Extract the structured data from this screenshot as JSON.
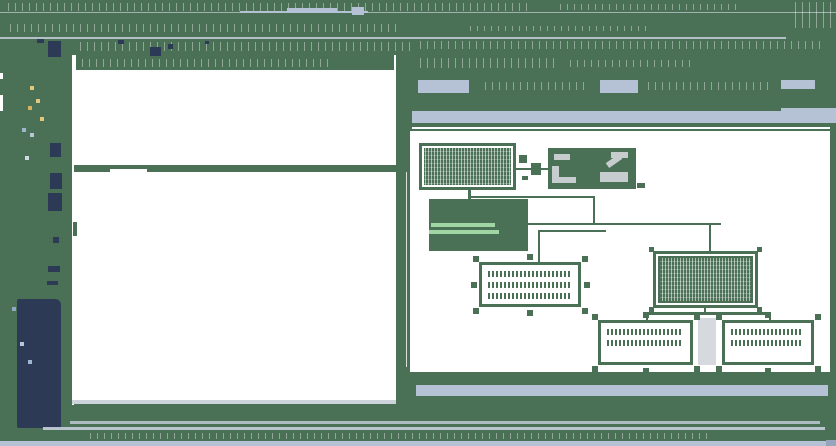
{
  "window": {
    "kind": "workflow-designer",
    "width": 836,
    "height": 446
  },
  "colors": {
    "chrome_green": "#4a7055",
    "navy_panel": "#2d3a55",
    "accent_blue_gray": "#b5c1d5",
    "thin_line_gray": "#c6cfdc",
    "canvas_white": "#ffffff",
    "gray_glyph": "#c7cccf",
    "annotation_text_green": "#9fd6a4"
  },
  "chrome": {
    "title_noise": [
      {
        "x": 8,
        "y": 3,
        "w": 520,
        "h": 8
      },
      {
        "x": 560,
        "y": 4,
        "w": 180,
        "h": 6
      },
      {
        "x": 795,
        "y": 2,
        "w": 38,
        "h": 26
      }
    ],
    "title_frags": [
      {
        "x": 240,
        "y": 11,
        "w": 128,
        "h": 2
      },
      {
        "x": 287,
        "y": 8,
        "w": 50,
        "h": 4
      },
      {
        "x": 352,
        "y": 7,
        "w": 12,
        "h": 8
      }
    ],
    "menu_noise": [
      {
        "x": 10,
        "y": 24,
        "w": 390,
        "h": 8
      },
      {
        "x": 470,
        "y": 26,
        "w": 180,
        "h": 5
      }
    ],
    "toolbar_noise": [
      {
        "x": 80,
        "y": 42,
        "w": 330,
        "h": 9
      },
      {
        "x": 420,
        "y": 41,
        "w": 400,
        "h": 8
      }
    ],
    "toolbar_icon_bits": [
      {
        "x": 37,
        "y": 39,
        "w": 7,
        "h": 4
      },
      {
        "x": 48,
        "y": 41,
        "w": 13,
        "h": 16
      },
      {
        "x": 118,
        "y": 40,
        "w": 6,
        "h": 4
      },
      {
        "x": 150,
        "y": 47,
        "w": 11,
        "h": 9
      },
      {
        "x": 168,
        "y": 44,
        "w": 5,
        "h": 5
      },
      {
        "x": 205,
        "y": 41,
        "w": 4,
        "h": 3
      }
    ],
    "edge_marks": [
      {
        "x": 0,
        "y": 73,
        "w": 3,
        "h": 6
      },
      {
        "x": 0,
        "y": 95,
        "w": 3,
        "h": 16
      }
    ]
  },
  "left_toolbar": {
    "icons": [
      {
        "name": "tool-icon-1",
        "x": 50,
        "y": 143,
        "w": 11,
        "h": 14
      },
      {
        "name": "tool-icon-2",
        "x": 50,
        "y": 173,
        "w": 12,
        "h": 16
      },
      {
        "name": "tool-icon-3",
        "x": 48,
        "y": 193,
        "w": 14,
        "h": 18
      },
      {
        "name": "tool-icon-4",
        "x": 53,
        "y": 237,
        "w": 6,
        "h": 6
      },
      {
        "name": "tool-icon-5",
        "x": 48,
        "y": 266,
        "w": 12,
        "h": 6
      },
      {
        "name": "tool-icon-6",
        "x": 47,
        "y": 281,
        "w": 11,
        "h": 4
      }
    ],
    "dots": [
      {
        "x": 30,
        "y": 86,
        "c": "#e3c67e"
      },
      {
        "x": 36,
        "y": 99,
        "c": "#e3c67e"
      },
      {
        "x": 28,
        "y": 106,
        "c": "#d8b25f"
      },
      {
        "x": 40,
        "y": 117,
        "c": "#e3c67e"
      },
      {
        "x": 22,
        "y": 128,
        "c": "#9fb6d0"
      },
      {
        "x": 30,
        "y": 133,
        "c": "#b9c6da"
      },
      {
        "x": 25,
        "y": 156,
        "c": "#cfd8e4"
      },
      {
        "x": 20,
        "y": 342,
        "c": "#b9c6da"
      },
      {
        "x": 28,
        "y": 360,
        "c": "#9fb6d0"
      },
      {
        "x": 12,
        "y": 307,
        "c": "#8fa8c4"
      }
    ]
  },
  "navy_panel": {
    "x": 17,
    "y": 299,
    "w": 44,
    "h": 129
  },
  "left_panel": {
    "x": 74,
    "y": 55,
    "w": 322,
    "h": 345,
    "header": {
      "x": 76,
      "y": 55,
      "w": 318,
      "h": 15
    },
    "grid_rows": [
      {
        "y": 71,
        "segs": [
          [
            76,
            80
          ],
          [
            168,
            60
          ],
          [
            240,
            60
          ],
          [
            312,
            40
          ],
          [
            358,
            34
          ]
        ]
      },
      {
        "y": 81,
        "segs": [
          [
            90,
            120
          ],
          [
            220,
            80
          ],
          [
            312,
            40
          ],
          [
            358,
            30
          ]
        ]
      },
      {
        "y": 92,
        "segs": [
          [
            76,
            50
          ],
          [
            140,
            160
          ],
          [
            312,
            42
          ],
          [
            356,
            36
          ]
        ]
      },
      {
        "y": 103,
        "segs": [
          [
            100,
            200
          ],
          [
            312,
            40
          ],
          [
            358,
            30
          ]
        ]
      },
      {
        "y": 113,
        "segs": [
          [
            76,
            70
          ],
          [
            155,
            145
          ],
          [
            312,
            42
          ],
          [
            358,
            34
          ]
        ]
      },
      {
        "y": 124,
        "segs": [
          [
            96,
            204
          ],
          [
            312,
            40
          ],
          [
            356,
            36
          ]
        ]
      },
      {
        "y": 134,
        "segs": [
          [
            76,
            224
          ],
          [
            312,
            42
          ],
          [
            358,
            30
          ]
        ]
      },
      {
        "y": 145,
        "segs": [
          [
            90,
            210
          ],
          [
            312,
            40
          ],
          [
            356,
            36
          ]
        ]
      },
      {
        "y": 156,
        "segs": [
          [
            76,
            120
          ],
          [
            205,
            95
          ],
          [
            312,
            42
          ],
          [
            358,
            30
          ]
        ]
      }
    ],
    "selection_blob": {
      "x": 77,
      "y": 125,
      "w": 16,
      "h": 32
    },
    "divider_band": {
      "x": 74,
      "y": 165,
      "w": 322,
      "h": 7
    },
    "band_notch": {
      "x": 110,
      "y": 169,
      "w": 37,
      "h": 4
    },
    "hscroll": {
      "x": 72,
      "y": 400,
      "w": 324,
      "h": 4
    }
  },
  "right_panel": {
    "header_noise": [
      {
        "x": 420,
        "y": 58,
        "w": 140,
        "h": 10
      },
      {
        "x": 570,
        "y": 60,
        "w": 120,
        "h": 7
      }
    ],
    "buttons": [
      {
        "name": "right-panel-button-1",
        "x": 418,
        "y": 80,
        "w": 51,
        "h": 13
      },
      {
        "name": "right-panel-button-2",
        "x": 600,
        "y": 80,
        "w": 38,
        "h": 13
      },
      {
        "name": "right-panel-button-3",
        "x": 781,
        "y": 80,
        "w": 34,
        "h": 9
      }
    ],
    "control_noise": [
      {
        "x": 485,
        "y": 82,
        "w": 100,
        "h": 8
      },
      {
        "x": 648,
        "y": 82,
        "w": 120,
        "h": 8
      }
    ],
    "tab_bar": {
      "x": 412,
      "y": 111,
      "w": 418,
      "h": 12
    },
    "tab_bar_cap": {
      "x": 781,
      "y": 108,
      "w": 55,
      "h": 15
    },
    "white_rule": {
      "x": 412,
      "y": 127,
      "w": 418,
      "h": 2
    },
    "canvas_bottom_band": {
      "x": 410,
      "y": 372,
      "w": 426,
      "h": 6
    },
    "hscrollbar": {
      "x": 416,
      "y": 385,
      "w": 412,
      "h": 11
    }
  },
  "canvas": {
    "origin": {
      "x": 410,
      "y": 131
    },
    "nodes": [
      {
        "name": "start-node",
        "x": 9,
        "y": 12,
        "w": 97,
        "h": 47,
        "style": "fill-dense"
      },
      {
        "name": "resource-node",
        "x": 138,
        "y": 17,
        "w": 88,
        "h": 41,
        "style": "fill-solid",
        "glyphs": true
      },
      {
        "name": "annotation-node",
        "x": 19,
        "y": 68,
        "w": 99,
        "h": 52,
        "style": "fill-solid",
        "textbars": [
          [
            21,
            34,
            64
          ],
          [
            19,
            41,
            70
          ]
        ]
      },
      {
        "name": "selected-task-node",
        "x": 69,
        "y": 131,
        "w": 102,
        "h": 45,
        "style": "fill-white",
        "noiserows": 3,
        "handles": "full"
      },
      {
        "name": "main-process-node",
        "x": 243,
        "y": 120,
        "w": 105,
        "h": 57,
        "style": "fill-dense dbl",
        "ticks": true
      },
      {
        "name": "sub-node-left",
        "x": 188,
        "y": 189,
        "w": 95,
        "h": 45,
        "style": "fill-white",
        "noiserows": 2,
        "handles": "corners"
      },
      {
        "name": "sub-node-right",
        "x": 312,
        "y": 189,
        "w": 92,
        "h": 45,
        "style": "fill-white",
        "noiserows": 2,
        "handles": "corners"
      }
    ],
    "link_bits": [
      {
        "x": 109,
        "y": 24,
        "w": 8,
        "h": 8
      },
      {
        "x": 121,
        "y": 32,
        "w": 10,
        "h": 12
      },
      {
        "x": 112,
        "y": 45,
        "w": 6,
        "h": 4
      },
      {
        "x": 227,
        "y": 52,
        "w": 8,
        "h": 5
      }
    ],
    "connectors": [
      {
        "x": 58,
        "y": 59,
        "w": 3,
        "h": 9
      },
      {
        "x": 106,
        "y": 37,
        "w": 32,
        "h": 2
      },
      {
        "x": 61,
        "y": 65,
        "w": 124,
        "h": 2
      },
      {
        "x": 183,
        "y": 65,
        "w": 2,
        "h": 28
      },
      {
        "x": 118,
        "y": 92,
        "w": 193,
        "h": 2
      },
      {
        "x": 299,
        "y": 94,
        "w": 2,
        "h": 26
      },
      {
        "x": 130,
        "y": 99,
        "w": 66,
        "h": 2
      },
      {
        "x": 128,
        "y": 99,
        "w": 2,
        "h": 32
      },
      {
        "x": 294,
        "y": 177,
        "w": 2,
        "h": 4
      },
      {
        "x": 237,
        "y": 181,
        "w": 124,
        "h": 3
      },
      {
        "x": 236,
        "y": 184,
        "w": 2,
        "h": 7
      },
      {
        "x": 359,
        "y": 184,
        "w": 2,
        "h": 7
      }
    ],
    "gray_strip": {
      "x": 288,
      "y": 187,
      "w": 18,
      "h": 47
    }
  },
  "footer": {
    "thin_line_1": {
      "x": 70,
      "y": 421,
      "w": 750,
      "h": 3
    },
    "thin_line_2": {
      "x": 43,
      "y": 427,
      "w": 782,
      "h": 3
    },
    "status_noise": {
      "x": 90,
      "y": 433,
      "w": 620,
      "h": 6
    },
    "bottom_bar": {
      "x": 0,
      "y": 441,
      "w": 836,
      "h": 5
    },
    "corner_chip": {
      "x": 826,
      "y": 440,
      "w": 10,
      "h": 6
    }
  }
}
